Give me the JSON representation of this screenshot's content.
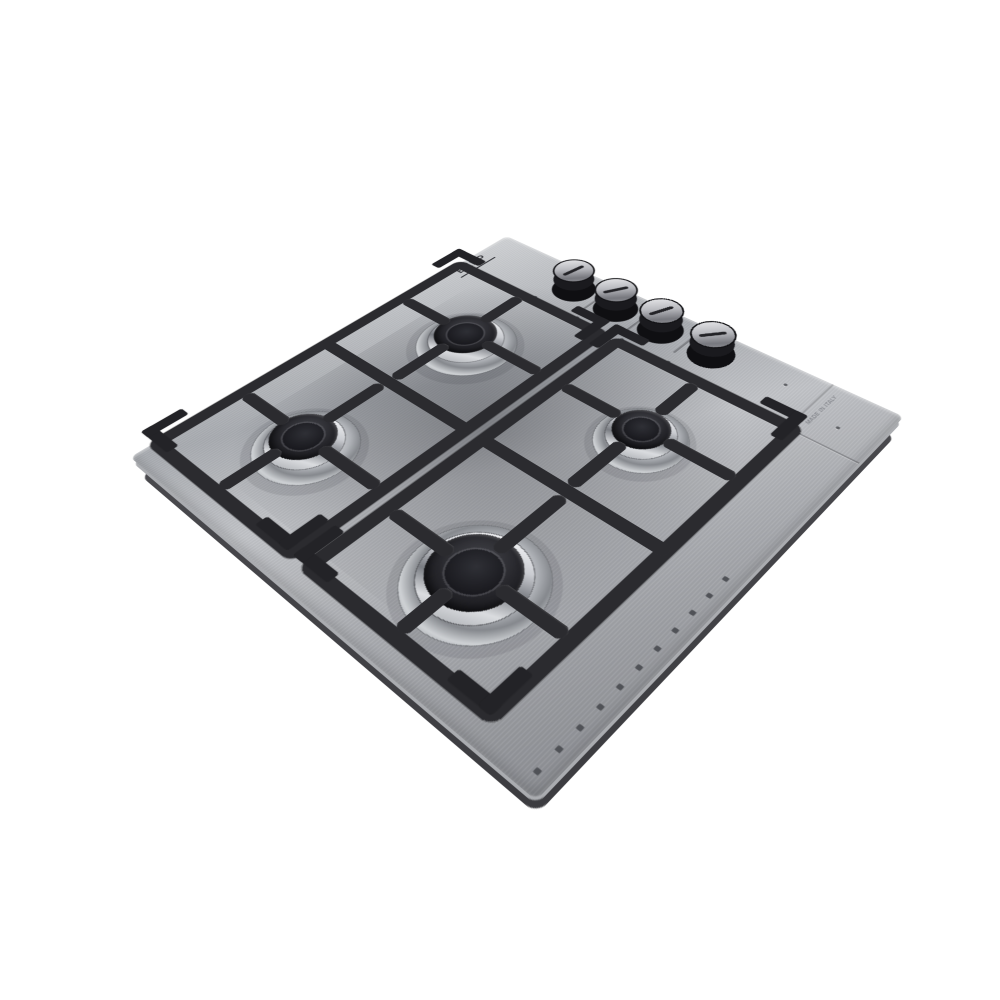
{
  "image_type": "product-photo",
  "caption": "Stainless steel four-burner gas cooktop photographed at an angle on a seamless white background",
  "brand": {
    "label": "EXEP"
  },
  "origin": {
    "label": "MADE IN ITALY"
  },
  "cooktop": {
    "surface_finish": "brushed stainless steel",
    "control_knobs": {
      "count": 4,
      "style": "black cylindrical knobs with brushed-metal tops and dark indicator slot",
      "location": "strip along upper-right edge"
    },
    "burners": [
      {
        "id": "back-left",
        "size": "medium",
        "parts": "aluminum base, chrome ring, matte black cap"
      },
      {
        "id": "back-right",
        "size": "small",
        "parts": "aluminum base, chrome ring, matte black cap"
      },
      {
        "id": "front-left",
        "size": "medium",
        "parts": "aluminum base, chrome ring, matte black cap"
      },
      {
        "id": "front-right",
        "size": "large",
        "parts": "aluminum base, chrome ring, matte black cap"
      }
    ],
    "pan_supports": {
      "count": 2,
      "material": "matte black cast iron",
      "features": "raised corner tabs, finger bars toward each burner"
    },
    "details": {
      "vent_holes": "row of small holes along lower-right edge",
      "panel_seams": "groove separating control strip from cooking area"
    }
  },
  "colors": {
    "background": "#ffffff",
    "steel_light": "#d2d4d7",
    "steel_dark": "#8e9095",
    "grate_black": "#2b2b2f",
    "burner_cap": "#1b1b1f",
    "chrome": "#f5f6f8",
    "underside": "#47474b"
  }
}
